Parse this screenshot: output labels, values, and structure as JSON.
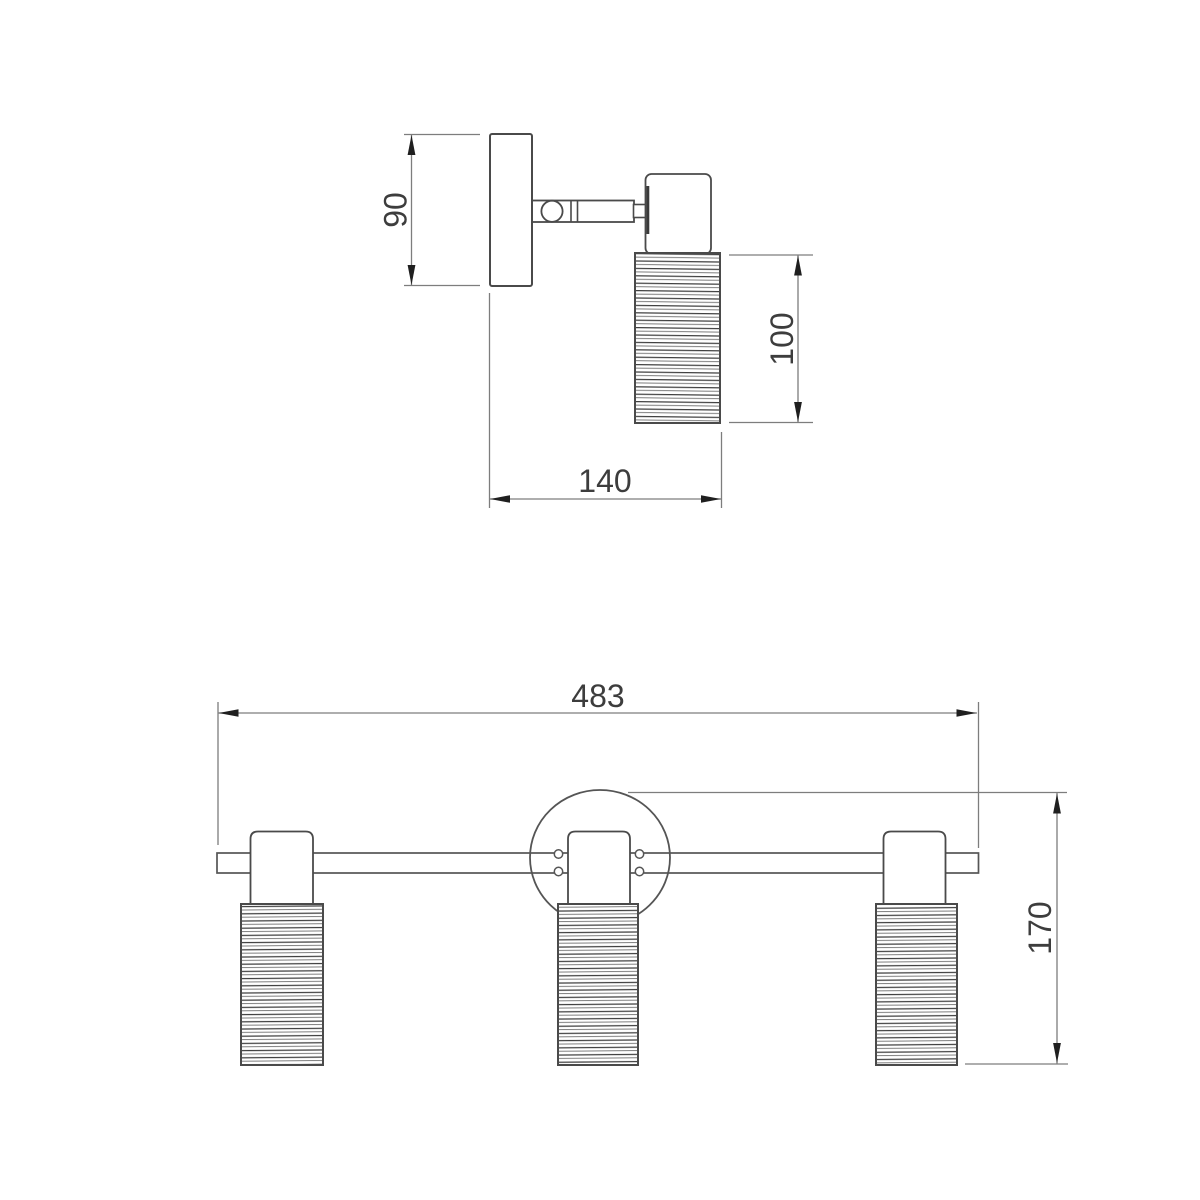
{
  "page": {
    "background": "#ffffff"
  },
  "palette": {
    "outline": "#4a4a4a",
    "dim_line": "#7d7d7d",
    "arrow": "#1f1f1f",
    "text": "#3d3d3d",
    "hatch_dark": "#3f3f3f",
    "hatch_light": "#6e6e6e"
  },
  "side_view": {
    "description": "single spot side view",
    "dim_plate_height": "90",
    "dim_shade_height": "100",
    "dim_depth": "140"
  },
  "front_view": {
    "description": "three spot front view",
    "dim_width": "483",
    "dim_height": "170"
  }
}
